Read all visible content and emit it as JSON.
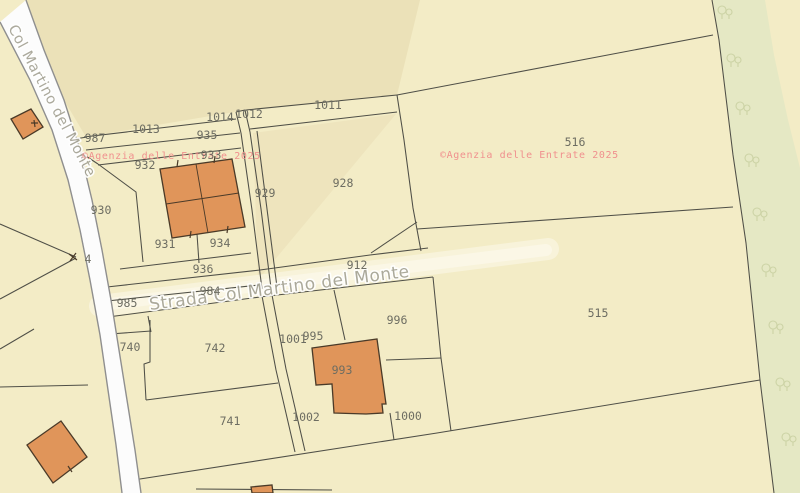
{
  "map": {
    "watermarks": [
      {
        "text": "©Agenzia delle Entrate 2025",
        "x": 82,
        "y": 159
      },
      {
        "text": "©Agenzia delle Entrate 2025",
        "x": 440,
        "y": 158
      }
    ],
    "roads": {
      "main_road_name": "Strada Col Martino del Monte",
      "side_road_name": "Col Martino del Monte"
    },
    "parcels": [
      {
        "number": "987",
        "x": 95,
        "y": 142
      },
      {
        "number": "1013",
        "x": 146,
        "y": 133
      },
      {
        "number": "1014",
        "x": 220,
        "y": 121
      },
      {
        "number": "1012",
        "x": 249,
        "y": 118
      },
      {
        "number": "1011",
        "x": 328,
        "y": 109
      },
      {
        "number": "935",
        "x": 207,
        "y": 139
      },
      {
        "number": "933",
        "x": 211,
        "y": 159
      },
      {
        "number": "932",
        "x": 145,
        "y": 169
      },
      {
        "number": "930",
        "x": 101,
        "y": 214
      },
      {
        "number": "929",
        "x": 265,
        "y": 197
      },
      {
        "number": "928",
        "x": 343,
        "y": 187
      },
      {
        "number": "931",
        "x": 165,
        "y": 248
      },
      {
        "number": "934",
        "x": 220,
        "y": 247
      },
      {
        "number": "936",
        "x": 203,
        "y": 273
      },
      {
        "number": "912",
        "x": 357,
        "y": 269
      },
      {
        "number": "984",
        "x": 210,
        "y": 295
      },
      {
        "number": "985",
        "x": 127,
        "y": 307
      },
      {
        "number": "740",
        "x": 130,
        "y": 351
      },
      {
        "number": "742",
        "x": 215,
        "y": 352
      },
      {
        "number": "741",
        "x": 230,
        "y": 425
      },
      {
        "number": "1001",
        "x": 293,
        "y": 343
      },
      {
        "number": "995",
        "x": 313,
        "y": 340
      },
      {
        "number": "996",
        "x": 397,
        "y": 324
      },
      {
        "number": "993",
        "x": 342,
        "y": 374
      },
      {
        "number": "1002",
        "x": 306,
        "y": 421
      },
      {
        "number": "1000",
        "x": 408,
        "y": 420
      },
      {
        "number": "515",
        "x": 598,
        "y": 317
      },
      {
        "number": "516",
        "x": 575,
        "y": 146
      },
      {
        "number": "4",
        "x": 88,
        "y": 263
      }
    ],
    "trees": [
      {
        "x": 722,
        "y": 10
      },
      {
        "x": 731,
        "y": 58
      },
      {
        "x": 740,
        "y": 106
      },
      {
        "x": 749,
        "y": 158
      },
      {
        "x": 757,
        "y": 212
      },
      {
        "x": 766,
        "y": 268
      },
      {
        "x": 773,
        "y": 325
      },
      {
        "x": 780,
        "y": 382
      },
      {
        "x": 786,
        "y": 437
      }
    ],
    "colors": {
      "base": "#f3ecc6",
      "shade": "#ebe1b8",
      "green": "#e5e8c4",
      "band": "#f8f3da",
      "band_core": "#fbf7e6",
      "road_fill": "#fcfcfc",
      "road_edge": "#8f8f8f",
      "parcel_line": "#4f4f47",
      "building_fill": "#e0955a",
      "building_stroke": "#4a3a28",
      "label": "#6d6d62",
      "watermark": "#f0908e",
      "road_label": "#a3a192",
      "tree": "#b9c28d"
    }
  }
}
